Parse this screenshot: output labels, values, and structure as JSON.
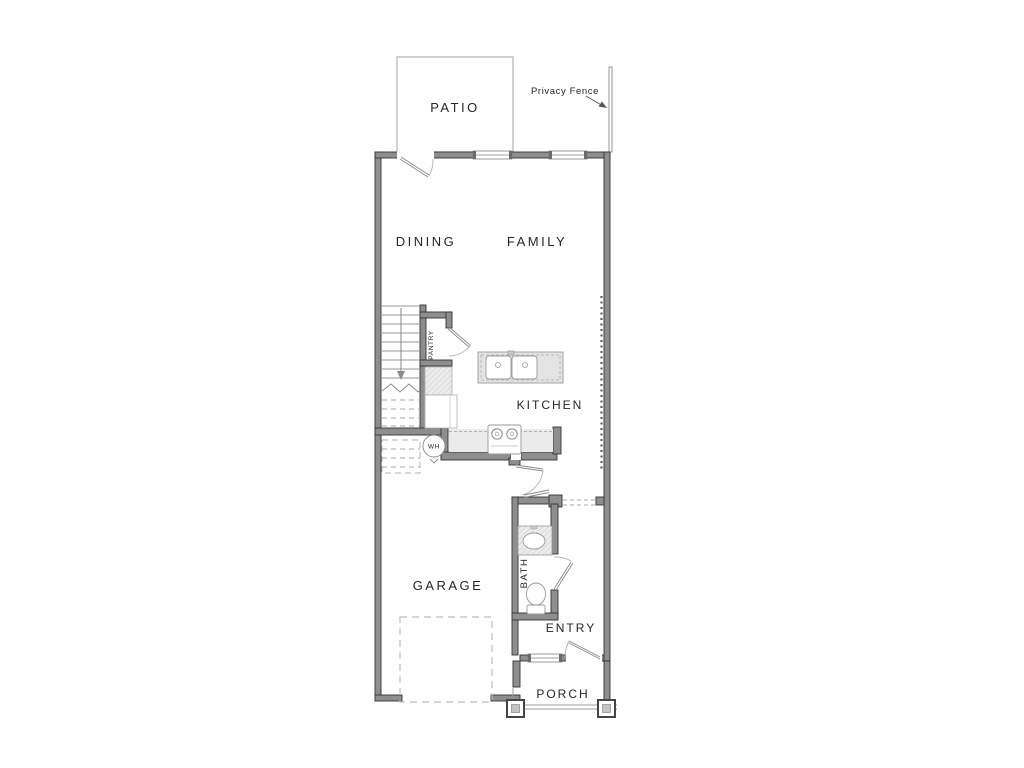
{
  "plan": {
    "room_labels": {
      "patio": "PATIO",
      "dining": "DINING",
      "family": "FAMILY",
      "pantry": "PANTRY",
      "kitchen": "KITCHEN",
      "garage": "GARAGE",
      "bath": "BATH",
      "entry": "ENTRY",
      "porch": "PORCH"
    },
    "annotations": {
      "privacy_fence": "Privacy Fence",
      "water_heater": "WH"
    },
    "colors": {
      "wall_fill": "#8e8e8e",
      "wall_outline": "#333333",
      "counter_fill": "#ebebeb",
      "island_fill": "#e4e4e4",
      "dashed_line": "#b8b8b8",
      "label_text": "#262626",
      "background": "#ffffff"
    }
  }
}
